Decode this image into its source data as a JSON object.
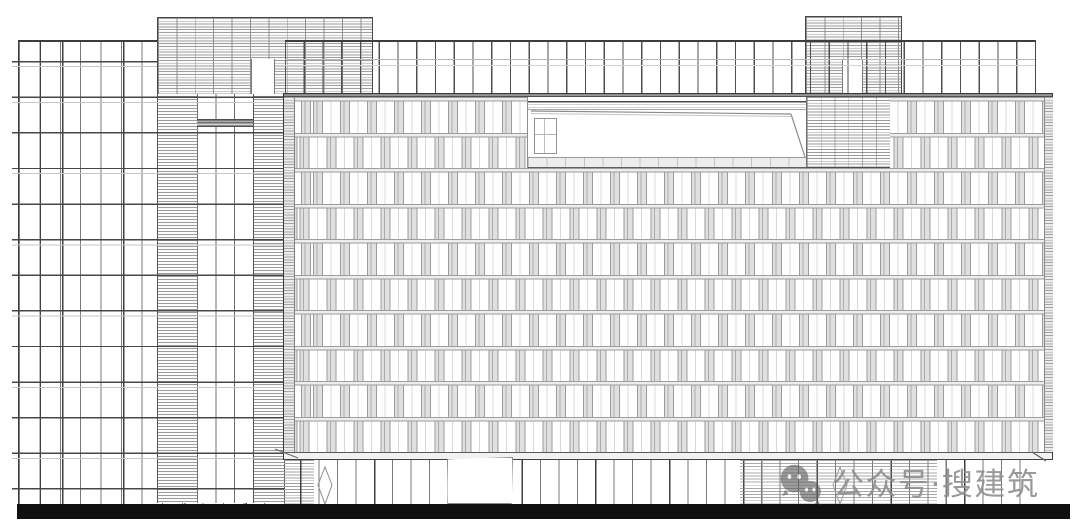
{
  "drawing": {
    "kind": "building-front-elevation-line-drawing"
  },
  "watermark": {
    "icon": "wechat-icon",
    "text": "公众号·搜建筑"
  },
  "colors": {
    "background": "#ffffff",
    "line_dark": "#3a3a3a",
    "line_mid": "#8a8a8a",
    "hatch": "#9c9c9c",
    "window_pier_fill": "#e0e0e0",
    "plinth_black": "#101010",
    "watermark_gray": "#8e8e8e"
  }
}
